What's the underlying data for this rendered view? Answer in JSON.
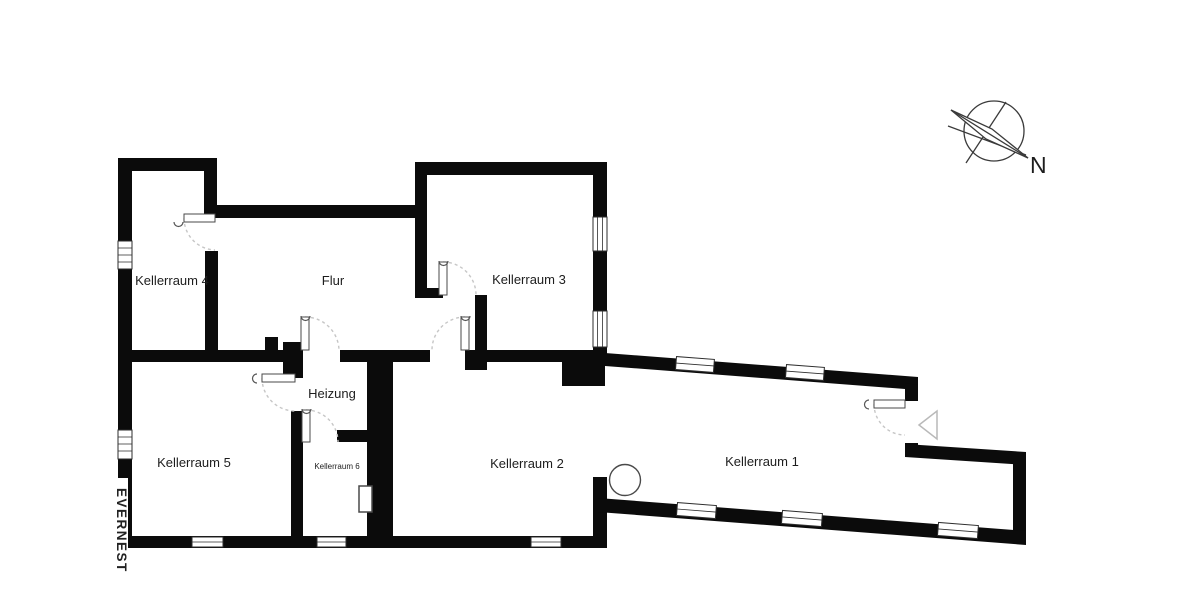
{
  "page": {
    "background": "#ffffff"
  },
  "colors": {
    "background": "#ffffff",
    "wall": "#0b0b0b",
    "door_arc": "#c6c6c6",
    "outline": "#3a3a3a",
    "label": "#1d1d1d"
  },
  "watermark": {
    "text": "EVERNEST"
  },
  "compass": {
    "label": "N"
  },
  "rooms": {
    "kellerraum4": {
      "label": "Kellerraum 4"
    },
    "flur": {
      "label": "Flur"
    },
    "kellerraum3": {
      "label": "Kellerraum 3"
    },
    "heizung": {
      "label": "Heizung"
    },
    "kellerraum5": {
      "label": "Kellerraum 5"
    },
    "kellerraum6": {
      "label": "Kellerraum 6"
    },
    "kellerraum2": {
      "label": "Kellerraum 2"
    },
    "kellerraum1": {
      "label": "Kellerraum 1"
    }
  }
}
